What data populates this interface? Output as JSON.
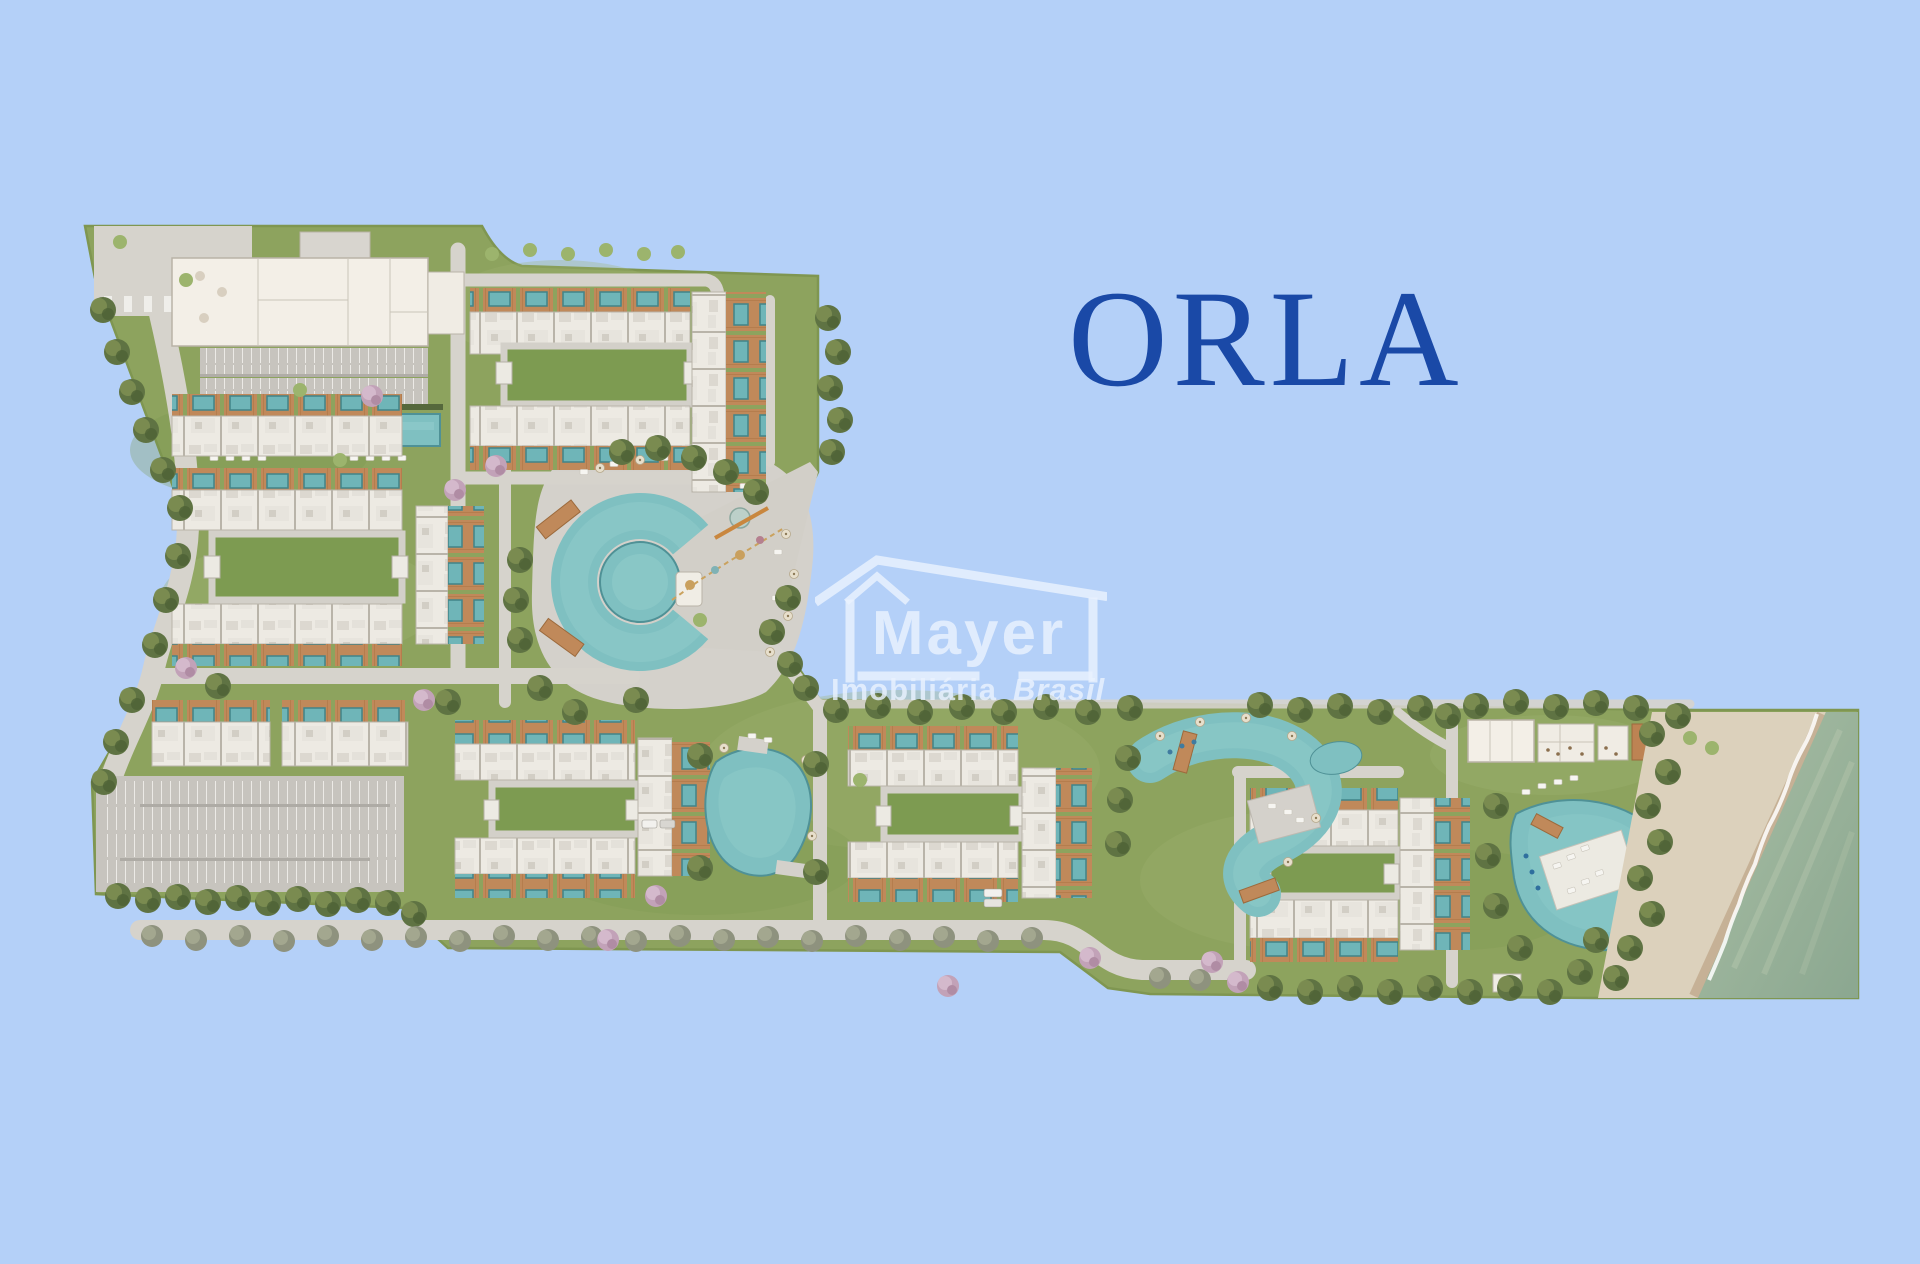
{
  "page": {
    "background_color": "#b4d0f8"
  },
  "header": {
    "title": "ORLA",
    "title_color": "#1a49a7"
  },
  "watermark": {
    "brand": "Mayer",
    "tagline_bold": "Imobiliária",
    "tagline_italic": "Brasil",
    "color": "#e9f1fd"
  },
  "palette": {
    "grass": "#8da35e",
    "road": "#d6d3cc",
    "pavement": "#d4d1cb",
    "unit_roof": "#edeae3",
    "wood_deck": "#c0895a",
    "plunge_pool": "#6fb5b8",
    "amenity_pool": "#7fc0c1",
    "parking": "#c7c4be",
    "sand": "#dcd1bc",
    "ocean": "#9ab397",
    "palm": "#5f7343",
    "street_tree": "#8e927e",
    "pink_tree": "#c2a2b8"
  }
}
